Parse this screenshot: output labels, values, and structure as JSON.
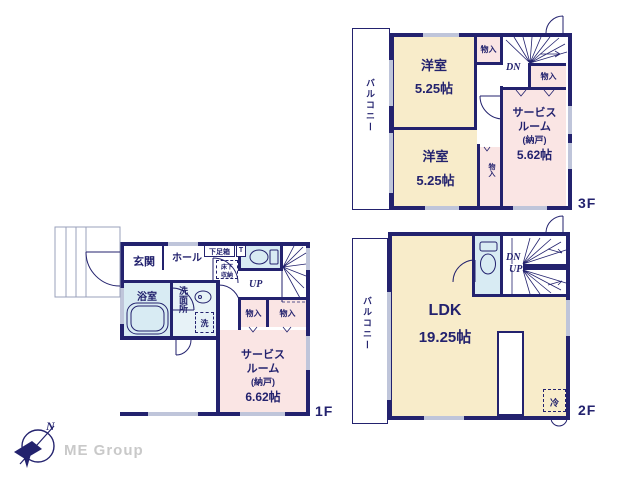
{
  "colors": {
    "wall": "#23226e",
    "room_cream": "#f8ecca",
    "room_pink": "#fae5e4",
    "room_blue": "#d8ebf3",
    "window_gray": "#bfc5da",
    "logo_gray": "#c9c9c9"
  },
  "floor3": {
    "floor_label": "3F",
    "balcony": "バルコニー",
    "room1": {
      "name": "洋室",
      "size": "5.25帖"
    },
    "room2": {
      "name": "洋室",
      "size": "5.25帖"
    },
    "service": {
      "line1": "サービス",
      "line2": "ルーム",
      "line3": "(納戸)",
      "line4": "5.62帖"
    },
    "closet_top": "物入",
    "closet_right": "物入",
    "closet_mid": "物入",
    "stair_dn": "DN"
  },
  "floor2": {
    "floor_label": "2F",
    "balcony": "バルコニー",
    "ldk": {
      "name": "LDK",
      "size": "19.25帖"
    },
    "stair_dn": "DN",
    "stair_up": "UP",
    "fridge": "冷"
  },
  "floor1": {
    "floor_label": "1F",
    "genkan": "玄関",
    "hall": "ホール",
    "shoebox": "下足箱",
    "shoebox_t": "T",
    "underfloor_line1": "床下",
    "underfloor_line2": "収納",
    "stair_up": "UP",
    "bath": "浴室",
    "washroom": "洗面所",
    "washer": "洗",
    "closet1": "物入",
    "closet2": "物入",
    "service": {
      "line1": "サービス",
      "line2": "ルーム",
      "line3": "(納戸)",
      "line4": "6.62帖"
    }
  },
  "logo": {
    "company": "ME Group",
    "compass_north": "N"
  }
}
